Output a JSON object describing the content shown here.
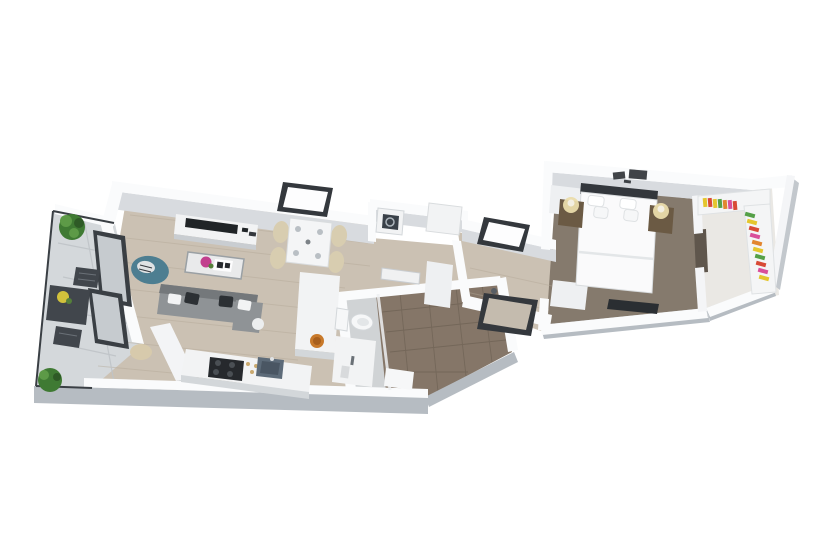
{
  "scene": {
    "kind": "3d-floorplan-render",
    "description": "Isometric 3D rendering of a one-bedroom apartment floor plan on a white background",
    "background": "#ffffff"
  },
  "palette": {
    "background": "#ffffff",
    "wall_top": "#fafbfc",
    "wall_face": "#d8dbdf",
    "wall_outer": "#b6bcc2",
    "rail_dark": "#3a3f44",
    "floor_wood": "#cbc1b3",
    "floor_wood_line": "#b3a897",
    "balcony_tile": "#d4d8db",
    "balcony_tile_line": "#bfc4c8",
    "bath_tile_brown": "#857668",
    "bath_tile_line": "#6d6154",
    "bath_floor_gray": "#d0d3d5",
    "carpet": "#857a6d",
    "closet_floor": "#eae8e4",
    "frame_dark": "#34383d",
    "glass_white": "#fdfdfe",
    "glass_gray": "#c6cbcf",
    "sofa": "#8f9396",
    "sofa_dark": "#74787b",
    "pillow_dark": "#2c3034",
    "accent_chair": "#4d7e91",
    "chair_beige": "#d8cdb0",
    "table_white": "#f4f5f6",
    "tv_dark": "#202427",
    "flower_pink": "#c23f8e",
    "flower_yellow": "#d2c23c",
    "plant_green": "#3f7a33",
    "plant_green_light": "#5d9a47",
    "outdoor_dark": "#41464c",
    "counter_white": "#f2f3f4",
    "counter_face": "#d3d7da",
    "stove_dark": "#26292d",
    "sink_steel": "#5d6b79",
    "bowl_orange": "#c8792a",
    "toilet_white": "#f6f7f8",
    "door_white": "#eef0f2",
    "bed_white": "#fafafb",
    "headboard_dark": "#33373c",
    "lamp_glow": "#eadcab",
    "nightstand_wood": "#6b5a44",
    "rug_dark": "#2a2e32",
    "clothes_colors": [
      "#e4c62e",
      "#d84a36",
      "#d94f9a",
      "#55a047",
      "#e2862f"
    ]
  },
  "rooms": [
    {
      "name": "balcony",
      "floor": "tile",
      "items": [
        "outdoor-table",
        "outdoor-chair",
        "outdoor-chair",
        "potted-plant",
        "potted-plant",
        "flower-pot"
      ]
    },
    {
      "name": "living-room",
      "floor": "wood",
      "items": [
        "sofa",
        "coffee-table",
        "accent-chair",
        "tv-console",
        "tv",
        "side-table",
        "pouf"
      ]
    },
    {
      "name": "dining-area",
      "floor": "wood",
      "items": [
        "dining-table",
        "dining-chair",
        "dining-chair",
        "dining-chair",
        "dining-chair",
        "skylight-window"
      ]
    },
    {
      "name": "kitchen",
      "floor": "wood",
      "items": [
        "counter",
        "gas-stove",
        "kitchen-sink",
        "island-column",
        "decor-bowl"
      ]
    },
    {
      "name": "bathroom",
      "floor": "tile",
      "items": [
        "toilet",
        "vanity",
        "shower",
        "bathroom-door"
      ]
    },
    {
      "name": "entry-hall",
      "floor": "wood",
      "items": [
        "washing-machine",
        "cabinet",
        "bench",
        "hall-window",
        "hall-window"
      ]
    },
    {
      "name": "bedroom",
      "floor": "carpet",
      "items": [
        "double-bed",
        "headboard",
        "pillows",
        "nightstand",
        "nightstand",
        "table-lamp",
        "table-lamp",
        "wall-art",
        "rug",
        "bedroom-door",
        "bedroom-door"
      ]
    },
    {
      "name": "walk-in-closet",
      "floor": "light",
      "items": [
        "wardrobe-shelf",
        "hanging-clothes"
      ]
    }
  ],
  "counts": {
    "windows": 5,
    "glass_panels": 2,
    "doors": 4,
    "plants": 2,
    "dining_chairs": 4,
    "bed_pillows": 4,
    "sofa_pillows": 4
  }
}
